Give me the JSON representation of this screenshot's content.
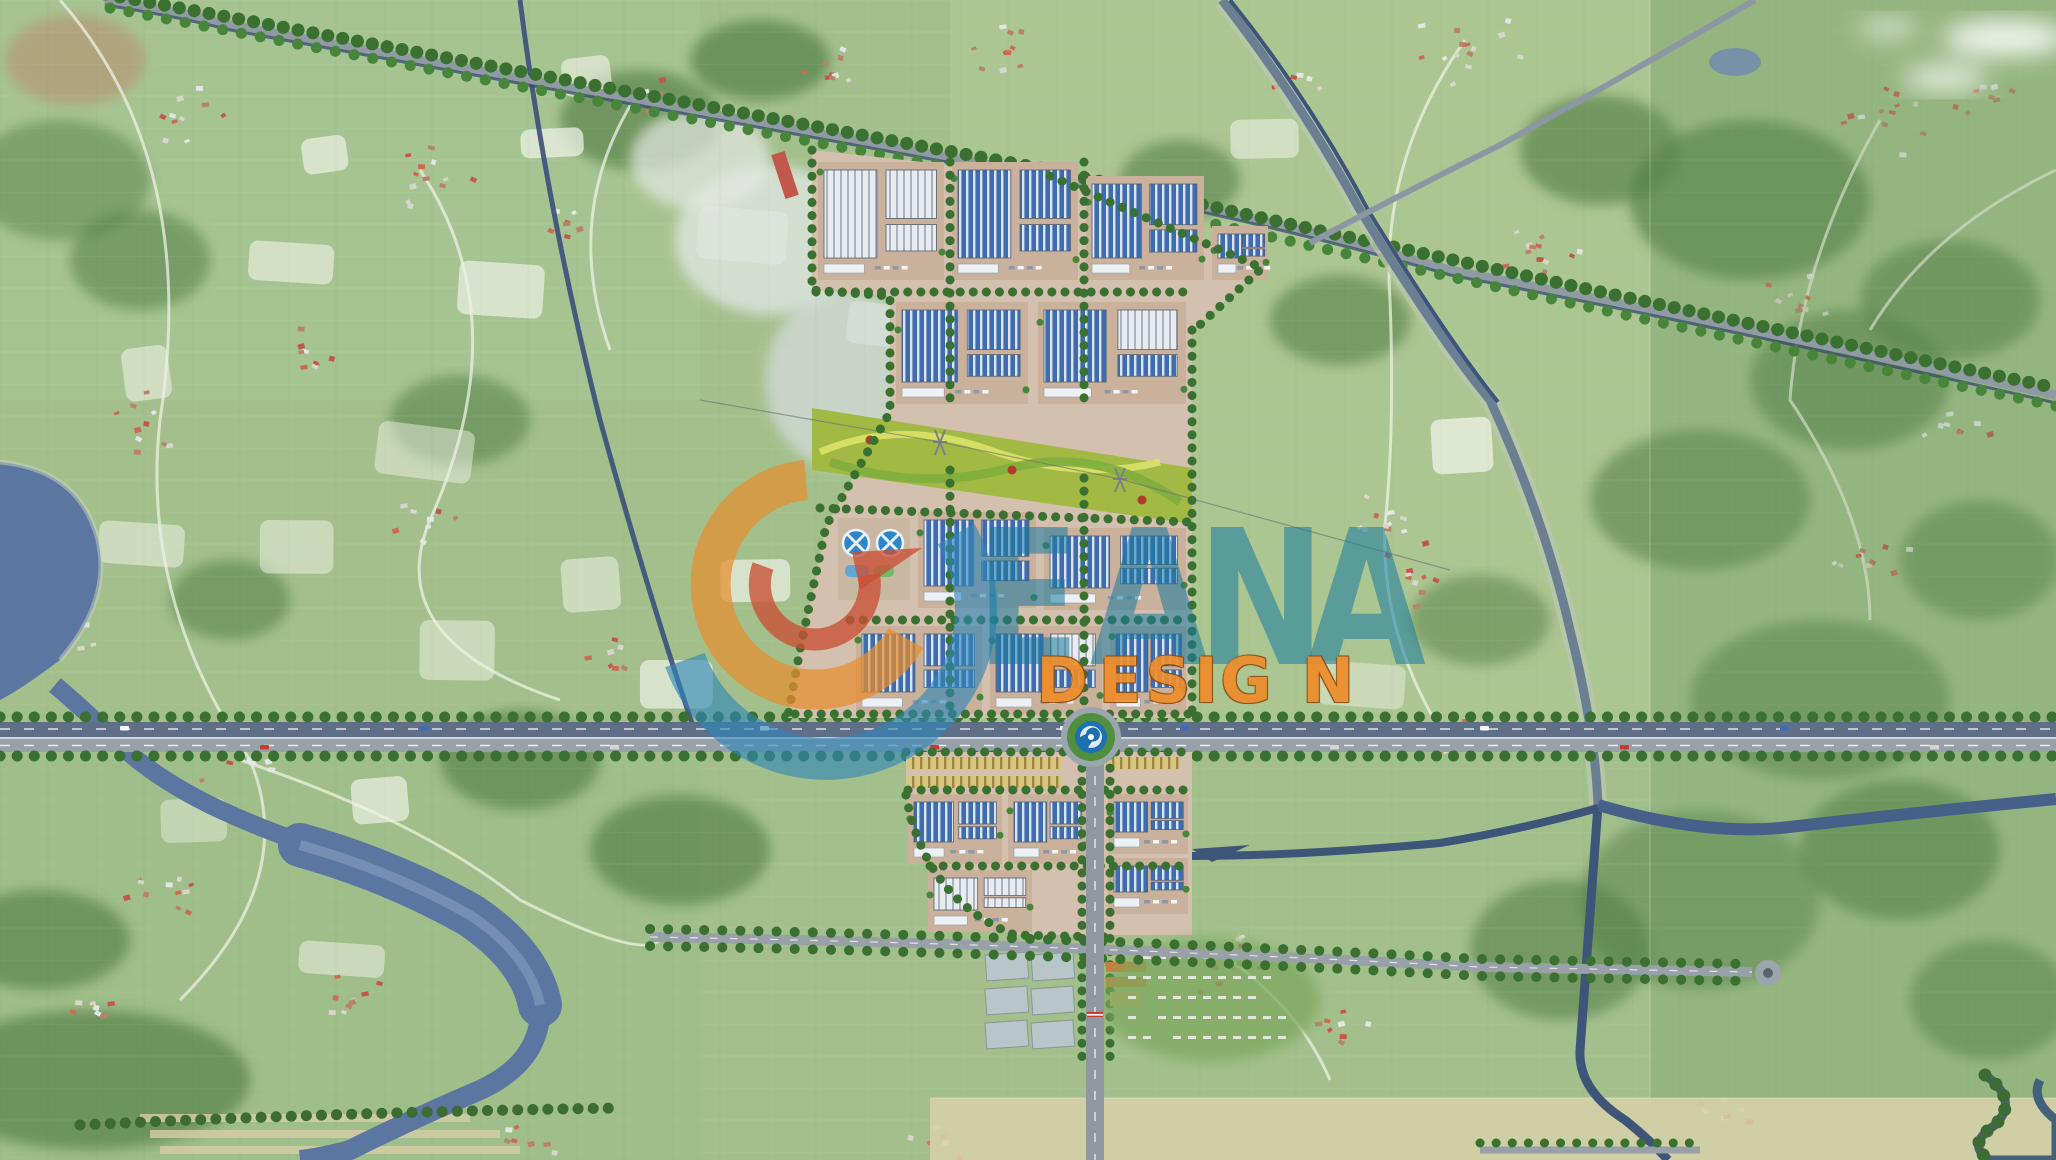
{
  "title": "Industrial park masterplan aerial rendering",
  "watermark": {
    "letters": [
      "E",
      "A",
      "N",
      "A"
    ],
    "design_letters": [
      "D",
      "E",
      "S",
      "I",
      "G",
      "N"
    ],
    "logo": {
      "name": "c-swoosh-logo",
      "outer_arc_color": "#2e86b8",
      "inner_arc_color": "#e68d2e",
      "swoosh_color": "#c94f35"
    },
    "letters_color": "#177aa0",
    "design_color": "#ef8d2a"
  },
  "scene": {
    "features": {
      "industrial_park": "industrial-park-masterplan",
      "highway": "main-highway",
      "roundabout": "highway-roundabout",
      "secondary_roundabout": "east-road-terminus-roundabout",
      "river": "river-west",
      "canal": "northeast-canal-road",
      "green_axis": "central-green-axis-park",
      "water_treatment": "water-treatment-tanks",
      "shophouses": "shophouse-rows",
      "tree_avenue": "tree-lined-avenue"
    },
    "colors": {
      "aerial_green": "#a3c08c",
      "dark_forest": "#547f47",
      "factory_roof_blue": "#4472b8",
      "factory_roof_white": "#eef1f4",
      "plan_ground_tan": "#d4c0ae",
      "road_gray": "#98a0a8",
      "navy_road": "#3c5680",
      "river_blue": "#5b76a0",
      "tree_green": "#3a7030",
      "axis_green": "#a2b944"
    }
  }
}
